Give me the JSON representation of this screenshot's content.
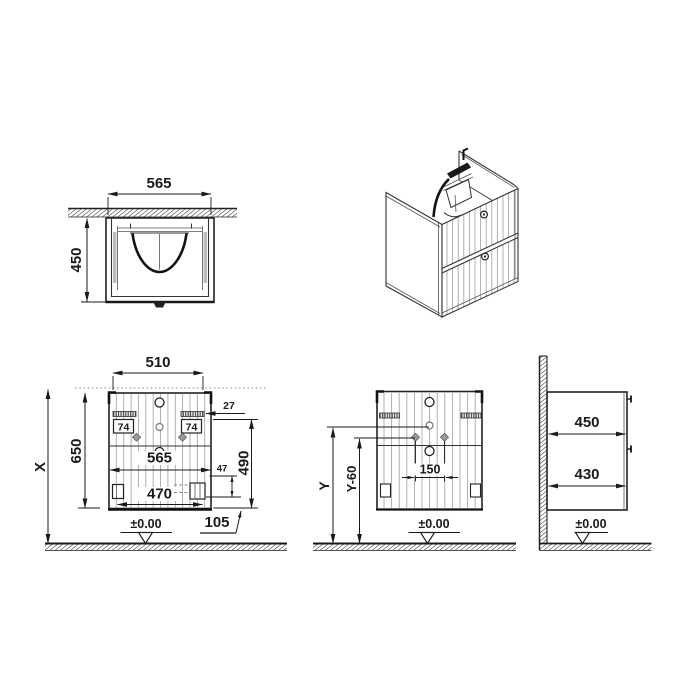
{
  "views": {
    "top_view": {
      "width": "565",
      "depth": "450"
    },
    "front_view": {
      "width_top": "510",
      "height_total": "X",
      "height_cabinet": "650",
      "offset_bracket": "27",
      "bracket_left": "74",
      "bracket_right": "74",
      "width_overall": "565",
      "offset_drain_v": "47",
      "drain_width": "32",
      "height_bracket": "490",
      "width_bottom": "470",
      "offset_right": "105",
      "floor_level": "±0.00"
    },
    "mount_view": {
      "height_basin": "Y",
      "height_bracket": "Y-60",
      "hole_spacing": "150",
      "floor_level": "±0.00"
    },
    "side_view": {
      "depth_upper": "450",
      "depth_lower": "430",
      "floor_level": "±0.00"
    }
  },
  "colors": {
    "line": "#1a1a1a",
    "flute": "#a8a8a8",
    "background": "#ffffff"
  }
}
